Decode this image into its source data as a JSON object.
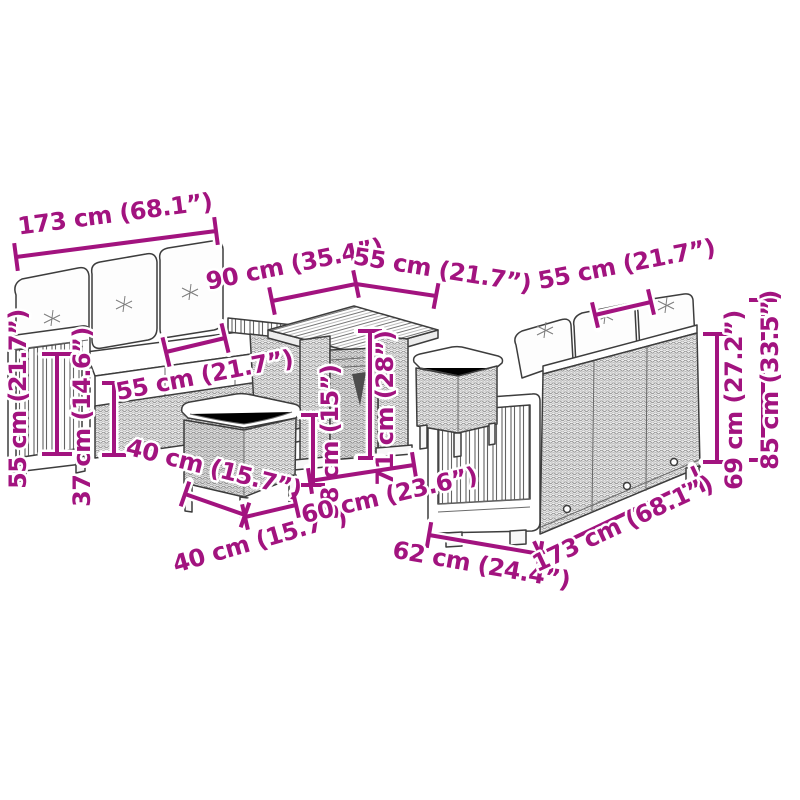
{
  "page": {
    "background_color": "#ffffff"
  },
  "diagram": {
    "accent_color": "#A2137F",
    "line_color": "#3d3d3d",
    "furniture_items": [
      "three-seater garden sofa with cushions",
      "square slatted-top garden table",
      "rattan footstool with cushion (front)",
      "rattan footstool with cushion (rear)",
      "garden sofa rear view with back cushions"
    ],
    "dimensions": [
      {
        "id": "sofa-left-length",
        "label": "173 cm (68.1”)"
      },
      {
        "id": "table-length",
        "label": "90 cm (35.4”)"
      },
      {
        "id": "table-depth",
        "label": "55 cm (21.7”)"
      },
      {
        "id": "sofa-right-seat-width",
        "label": "55 cm (21.7”)"
      },
      {
        "id": "sofa-left-height",
        "label": "55 cm (21.7”)"
      },
      {
        "id": "sofa-left-seat-height",
        "label": "37 cm (14.6”)"
      },
      {
        "id": "sofa-left-seat-width",
        "label": "55 cm (21.7”)"
      },
      {
        "id": "stool-depth",
        "label": "40 cm (15.7”)"
      },
      {
        "id": "stool-width",
        "label": "40 cm (15.7”)"
      },
      {
        "id": "stool-height",
        "label": "38 cm (15”)"
      },
      {
        "id": "table-height",
        "label": "71 cm (28”)"
      },
      {
        "id": "table-base-width",
        "label": "60 cm (23.6”)"
      },
      {
        "id": "sofa-right-depth",
        "label": "62 cm (24.4”)"
      },
      {
        "id": "sofa-right-length",
        "label": "173 cm (68.1”)"
      },
      {
        "id": "sofa-right-back-height",
        "label": "69 cm (27.2”)"
      },
      {
        "id": "sofa-right-total-height",
        "label": "85 cm (33.5”)"
      }
    ]
  }
}
